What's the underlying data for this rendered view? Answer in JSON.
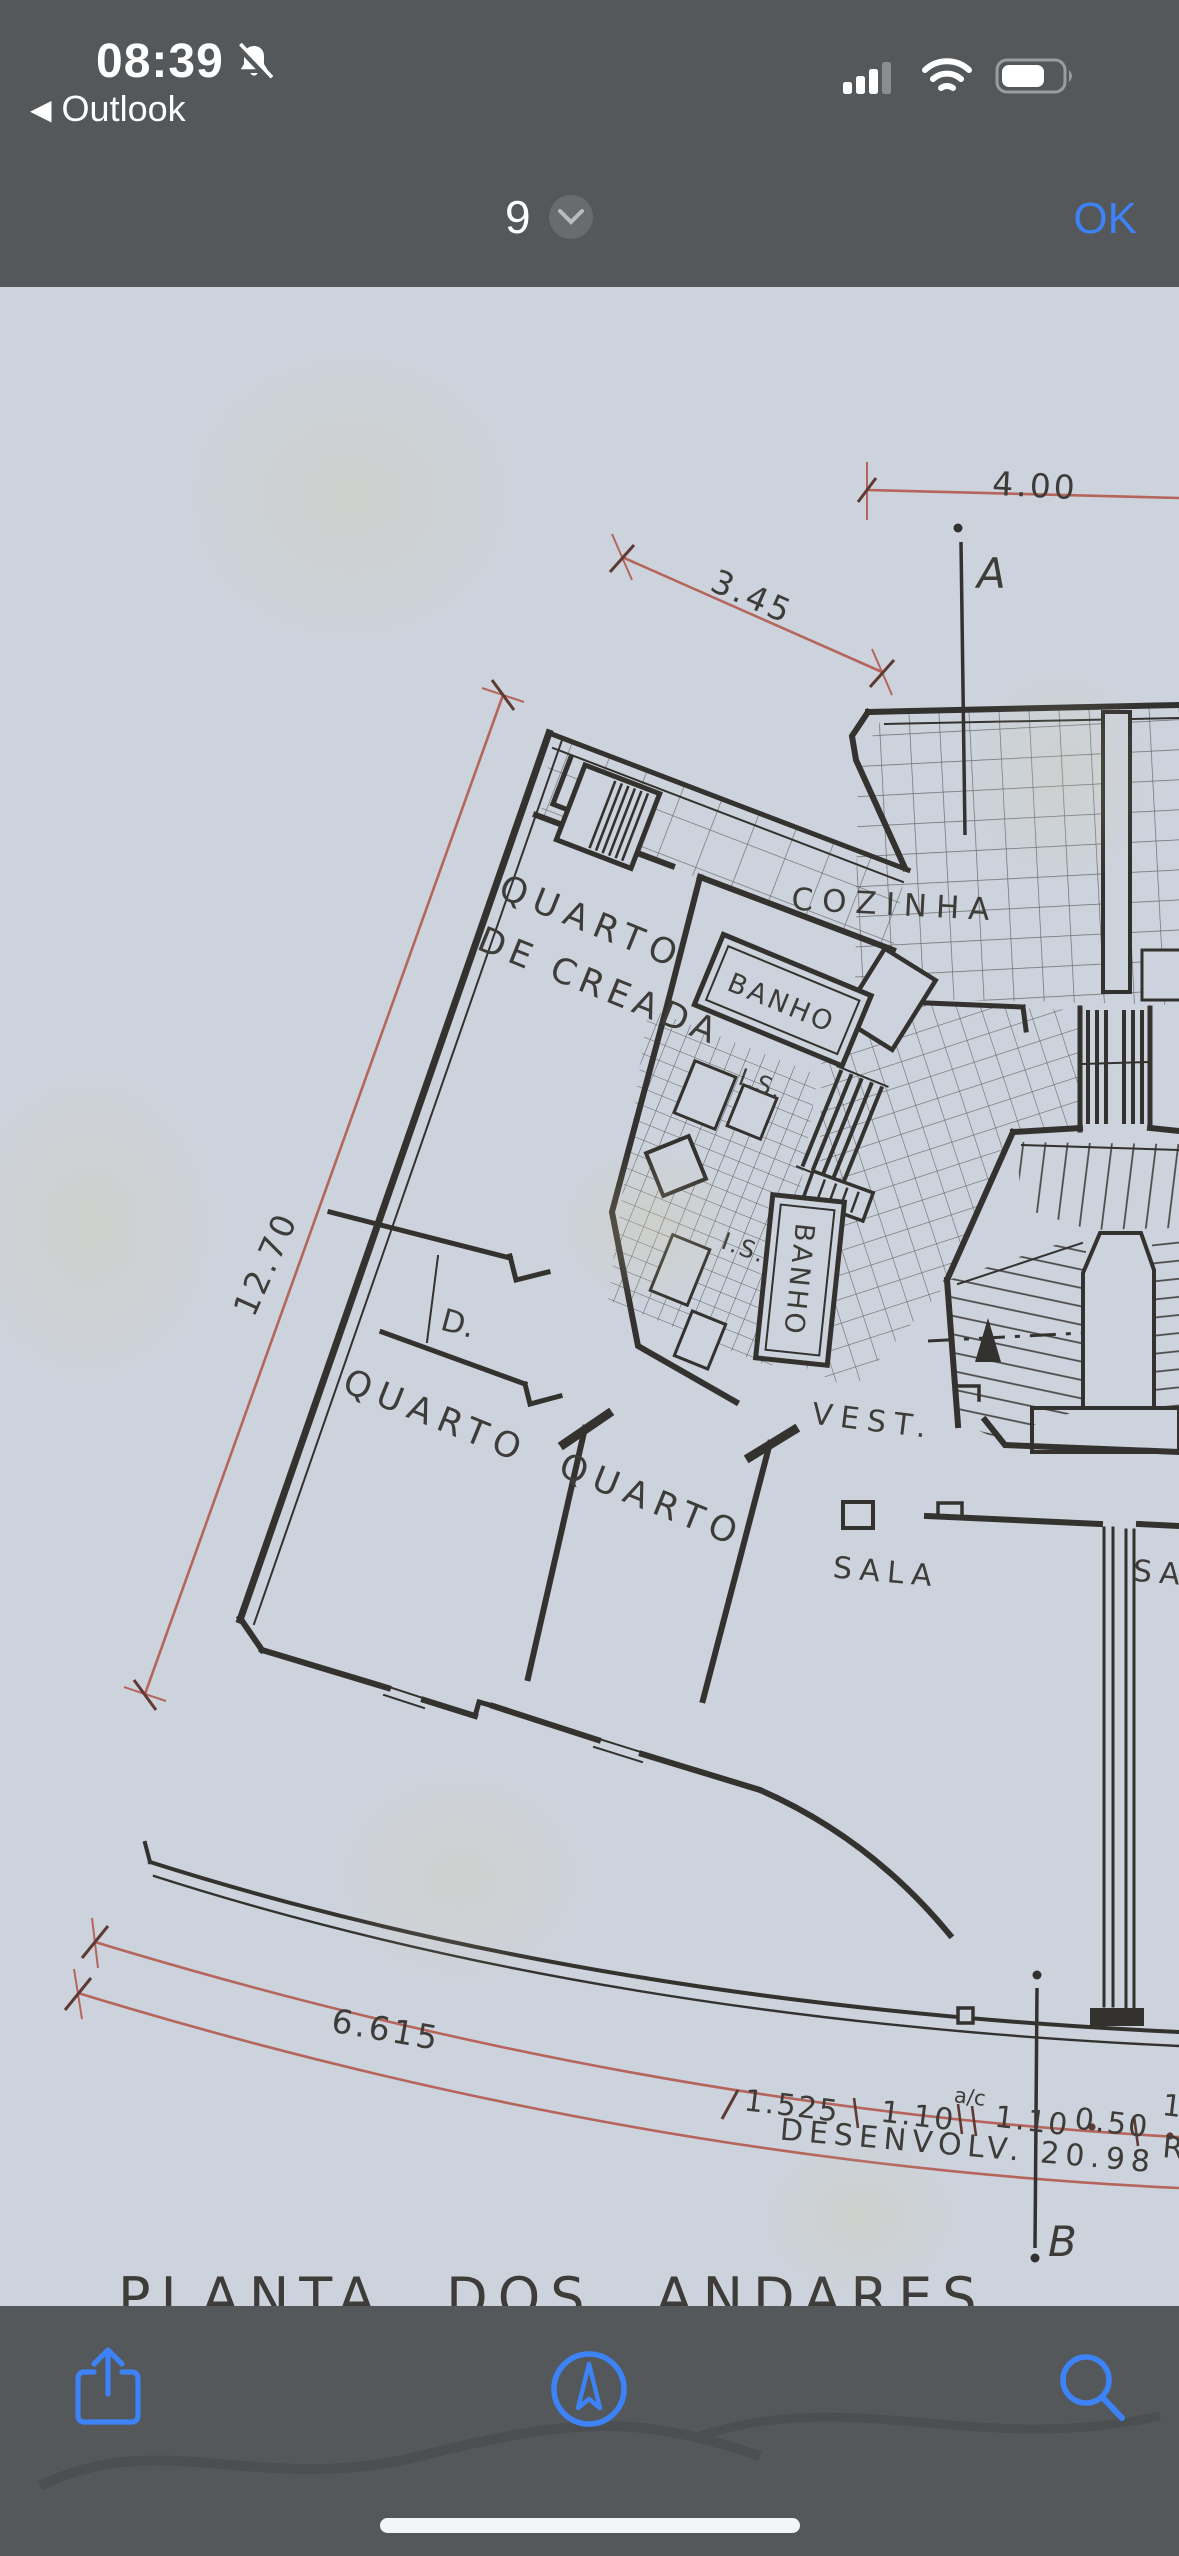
{
  "status_bar": {
    "time": "08:39",
    "back_chevron": "◀",
    "back_label": "Outlook",
    "icons": [
      "silenced-bell-icon",
      "cell-signal-icon",
      "wifi-icon",
      "battery-icon"
    ]
  },
  "nav_bar": {
    "page_number": "9",
    "page_selector_icon": "chevron-down-icon",
    "ok_label": "OK",
    "accent_color": "#3d82f7"
  },
  "toolbar": {
    "icons": [
      "share-icon",
      "markup-icon",
      "search-icon"
    ],
    "icon_color": "#3d82f7"
  },
  "drawing": {
    "title": "PLANTA  DOS  ANDARES",
    "rooms": {
      "quarto_creada_line1": "QUARTO",
      "quarto_creada_line2": "DE CREADA",
      "banho_upper": "BANHO",
      "is_upper": "I.S.",
      "is_lower": "I.S.",
      "banho_lower": "BANHO",
      "cozinha": "COZINHA",
      "vest": "VEST.",
      "sala": "SALA",
      "sala_fragment": "SA",
      "quarto_1": "QUARTO",
      "quarto_2": "QUARTO",
      "closet": "D."
    },
    "dimensions": {
      "top": "4.00",
      "upper_diagonal": "3.45",
      "left_diagonal": "12.70",
      "bottom_left": "6.615",
      "seg1": "1.525",
      "seg2": "1.10",
      "seg2_sup": "a/c",
      "seg3": "1.10",
      "seg4": "0.50",
      "seg5": "1",
      "development": "DESENVOLV.  20.98",
      "fragment_right": "R"
    },
    "section_marks": {
      "a": "A",
      "b": "B"
    },
    "ink_color": "#34322f",
    "dimension_line_color": "#b5655c",
    "paper_color": "#cdd3dc"
  }
}
